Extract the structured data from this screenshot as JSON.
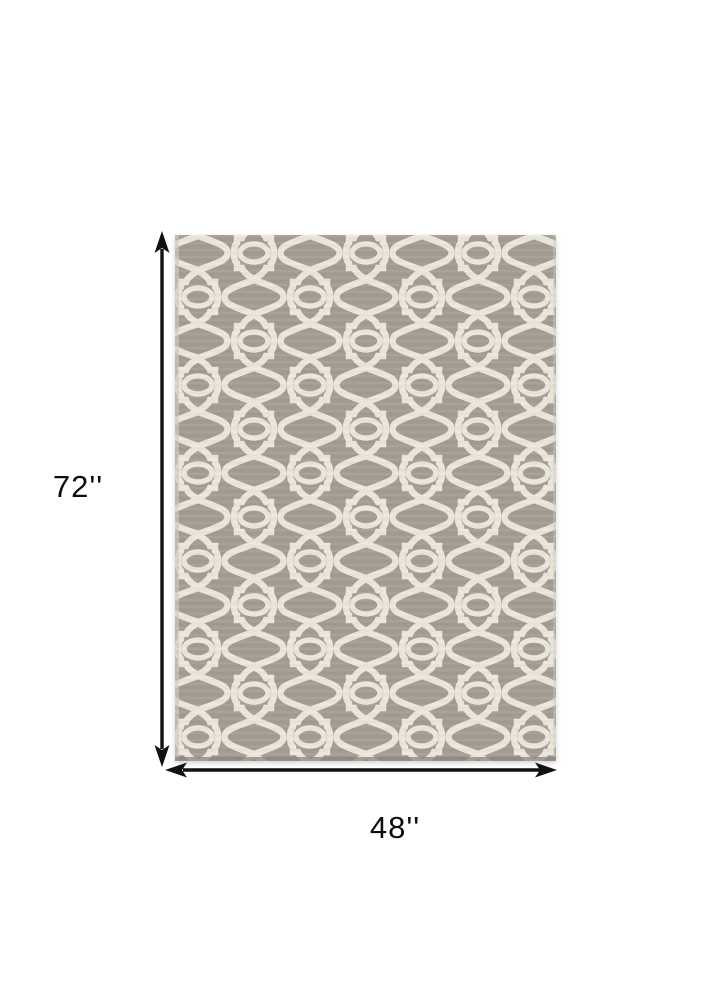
{
  "diagram": {
    "height_label": "72''",
    "width_label": "48''",
    "product_description": "Gray and ivory Moroccan trellis patterned area rug"
  },
  "theme": {
    "background": "#ffffff",
    "rug_gray": "#a39d94",
    "rug_cream": "#ece7db",
    "rug_edge_light": "#cfcac1",
    "rug_edge_dark": "#8b867f",
    "arrow_color": "#111111",
    "label_color": "#0d0d0d"
  }
}
